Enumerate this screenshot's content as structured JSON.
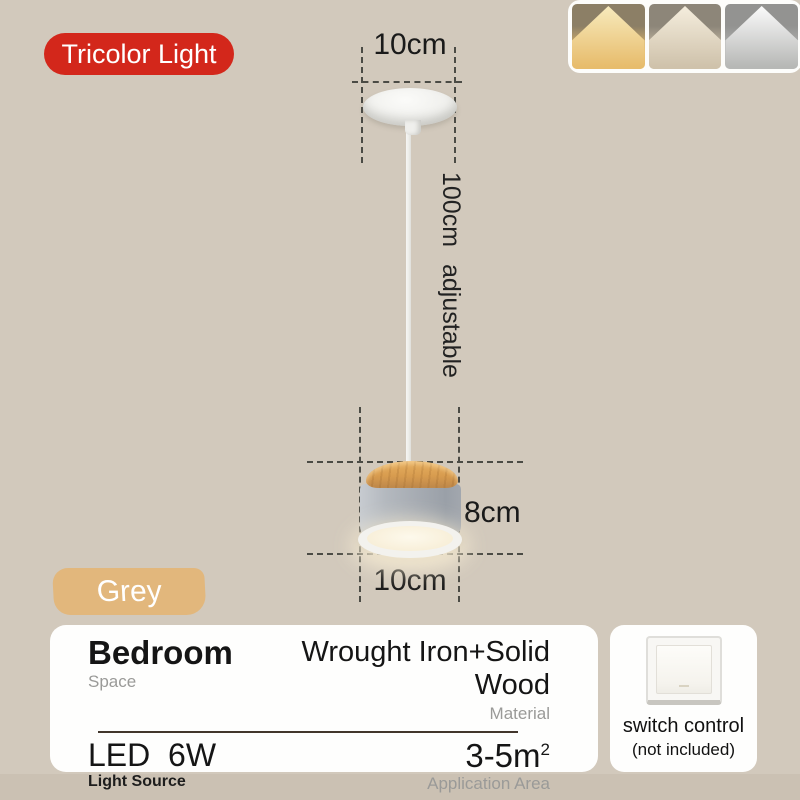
{
  "badges": {
    "feature": "Tricolor Light",
    "color_variant": "Grey"
  },
  "light_modes": [
    {
      "name": "warm-light",
      "top": "#8c7f66",
      "beam": "#f8ecbf",
      "lit": "#e7bc6c"
    },
    {
      "name": "neutral-light",
      "top": "#8d8679",
      "beam": "#f6efdf",
      "lit": "#cfc2ab"
    },
    {
      "name": "cool-light",
      "top": "#939391",
      "beam": "#fdfdfd",
      "lit": "#b7b8b6"
    }
  ],
  "dimensions": {
    "canopy_diameter": "10cm",
    "cord_length": "100cm adjustable",
    "lamp_height": "8cm",
    "lamp_diameter": "10cm"
  },
  "specs": {
    "space": {
      "value": "Bedroom",
      "label": "Space"
    },
    "material": {
      "value": "Wrought Iron+Solid Wood",
      "label": "Material"
    },
    "light_source": {
      "value": "LED  6W",
      "label": "Light Source"
    },
    "application_area": {
      "value": "3-5m",
      "sup": "2",
      "label": "Application Area"
    }
  },
  "switch_note": {
    "line1": "switch control",
    "line2": "(not included)"
  },
  "colors": {
    "background": "#d2c9bc",
    "badge_red": "#d3271b",
    "badge_tan": "#e2b77c",
    "dash": "#4b4b45",
    "wood": "#d89c4f",
    "lamp_grey": "#a7acb3"
  }
}
